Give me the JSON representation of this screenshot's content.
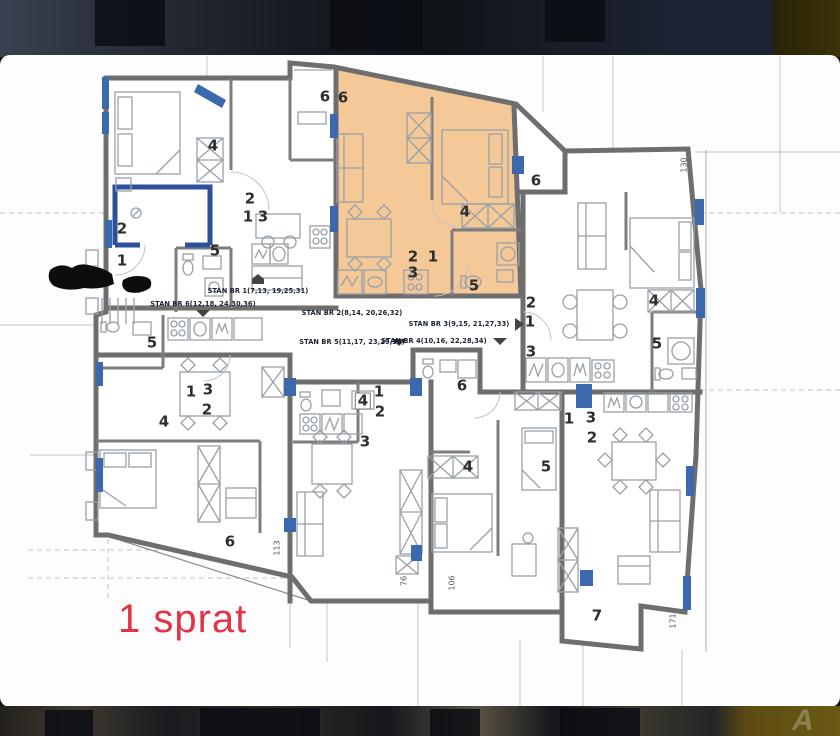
{
  "photo_strip": {
    "watermark": "A"
  },
  "plan": {
    "floor_title": "1 sprat",
    "accent_red": "#e23448",
    "highlight_orange": "#f5c897",
    "marker_blue": "#3c68ae",
    "apartment_labels": [
      {
        "text": "STAN BR 1(7,13, 19,25,31)"
      },
      {
        "text": "STAN BR 2(8,14, 20,26,32)"
      },
      {
        "text": "STAN BR 3(9,15, 21,27,33)"
      },
      {
        "text": "STAN BR 4(10,16, 22,28,34)"
      },
      {
        "text": "STAN BR 5(11,17, 23,29,35)"
      },
      {
        "text": "STAN BR 6(12,18, 24,30,36)"
      }
    ],
    "room_numbers": [
      {
        "t": "6"
      },
      {
        "t": "6"
      },
      {
        "t": "4"
      },
      {
        "t": "2"
      },
      {
        "t": "1"
      },
      {
        "t": "3"
      },
      {
        "t": "2"
      },
      {
        "t": "1"
      },
      {
        "t": "5"
      },
      {
        "t": "4"
      },
      {
        "t": "2"
      },
      {
        "t": "1"
      },
      {
        "t": "3"
      },
      {
        "t": "5"
      },
      {
        "t": "6"
      },
      {
        "t": "2"
      },
      {
        "t": "1"
      },
      {
        "t": "3"
      },
      {
        "t": "4"
      },
      {
        "t": "5"
      },
      {
        "t": "5"
      },
      {
        "t": "1"
      },
      {
        "t": "3"
      },
      {
        "t": "2"
      },
      {
        "t": "4"
      },
      {
        "t": "6"
      },
      {
        "t": "1"
      },
      {
        "t": "4"
      },
      {
        "t": "2"
      },
      {
        "t": "3"
      },
      {
        "t": "6"
      },
      {
        "t": "4"
      },
      {
        "t": "5"
      },
      {
        "t": "1"
      },
      {
        "t": "3"
      },
      {
        "t": "2"
      },
      {
        "t": "7"
      }
    ],
    "dimensions": [
      {
        "t": "130"
      },
      {
        "t": "113"
      },
      {
        "t": "76"
      },
      {
        "t": "106"
      },
      {
        "t": "171"
      }
    ]
  }
}
